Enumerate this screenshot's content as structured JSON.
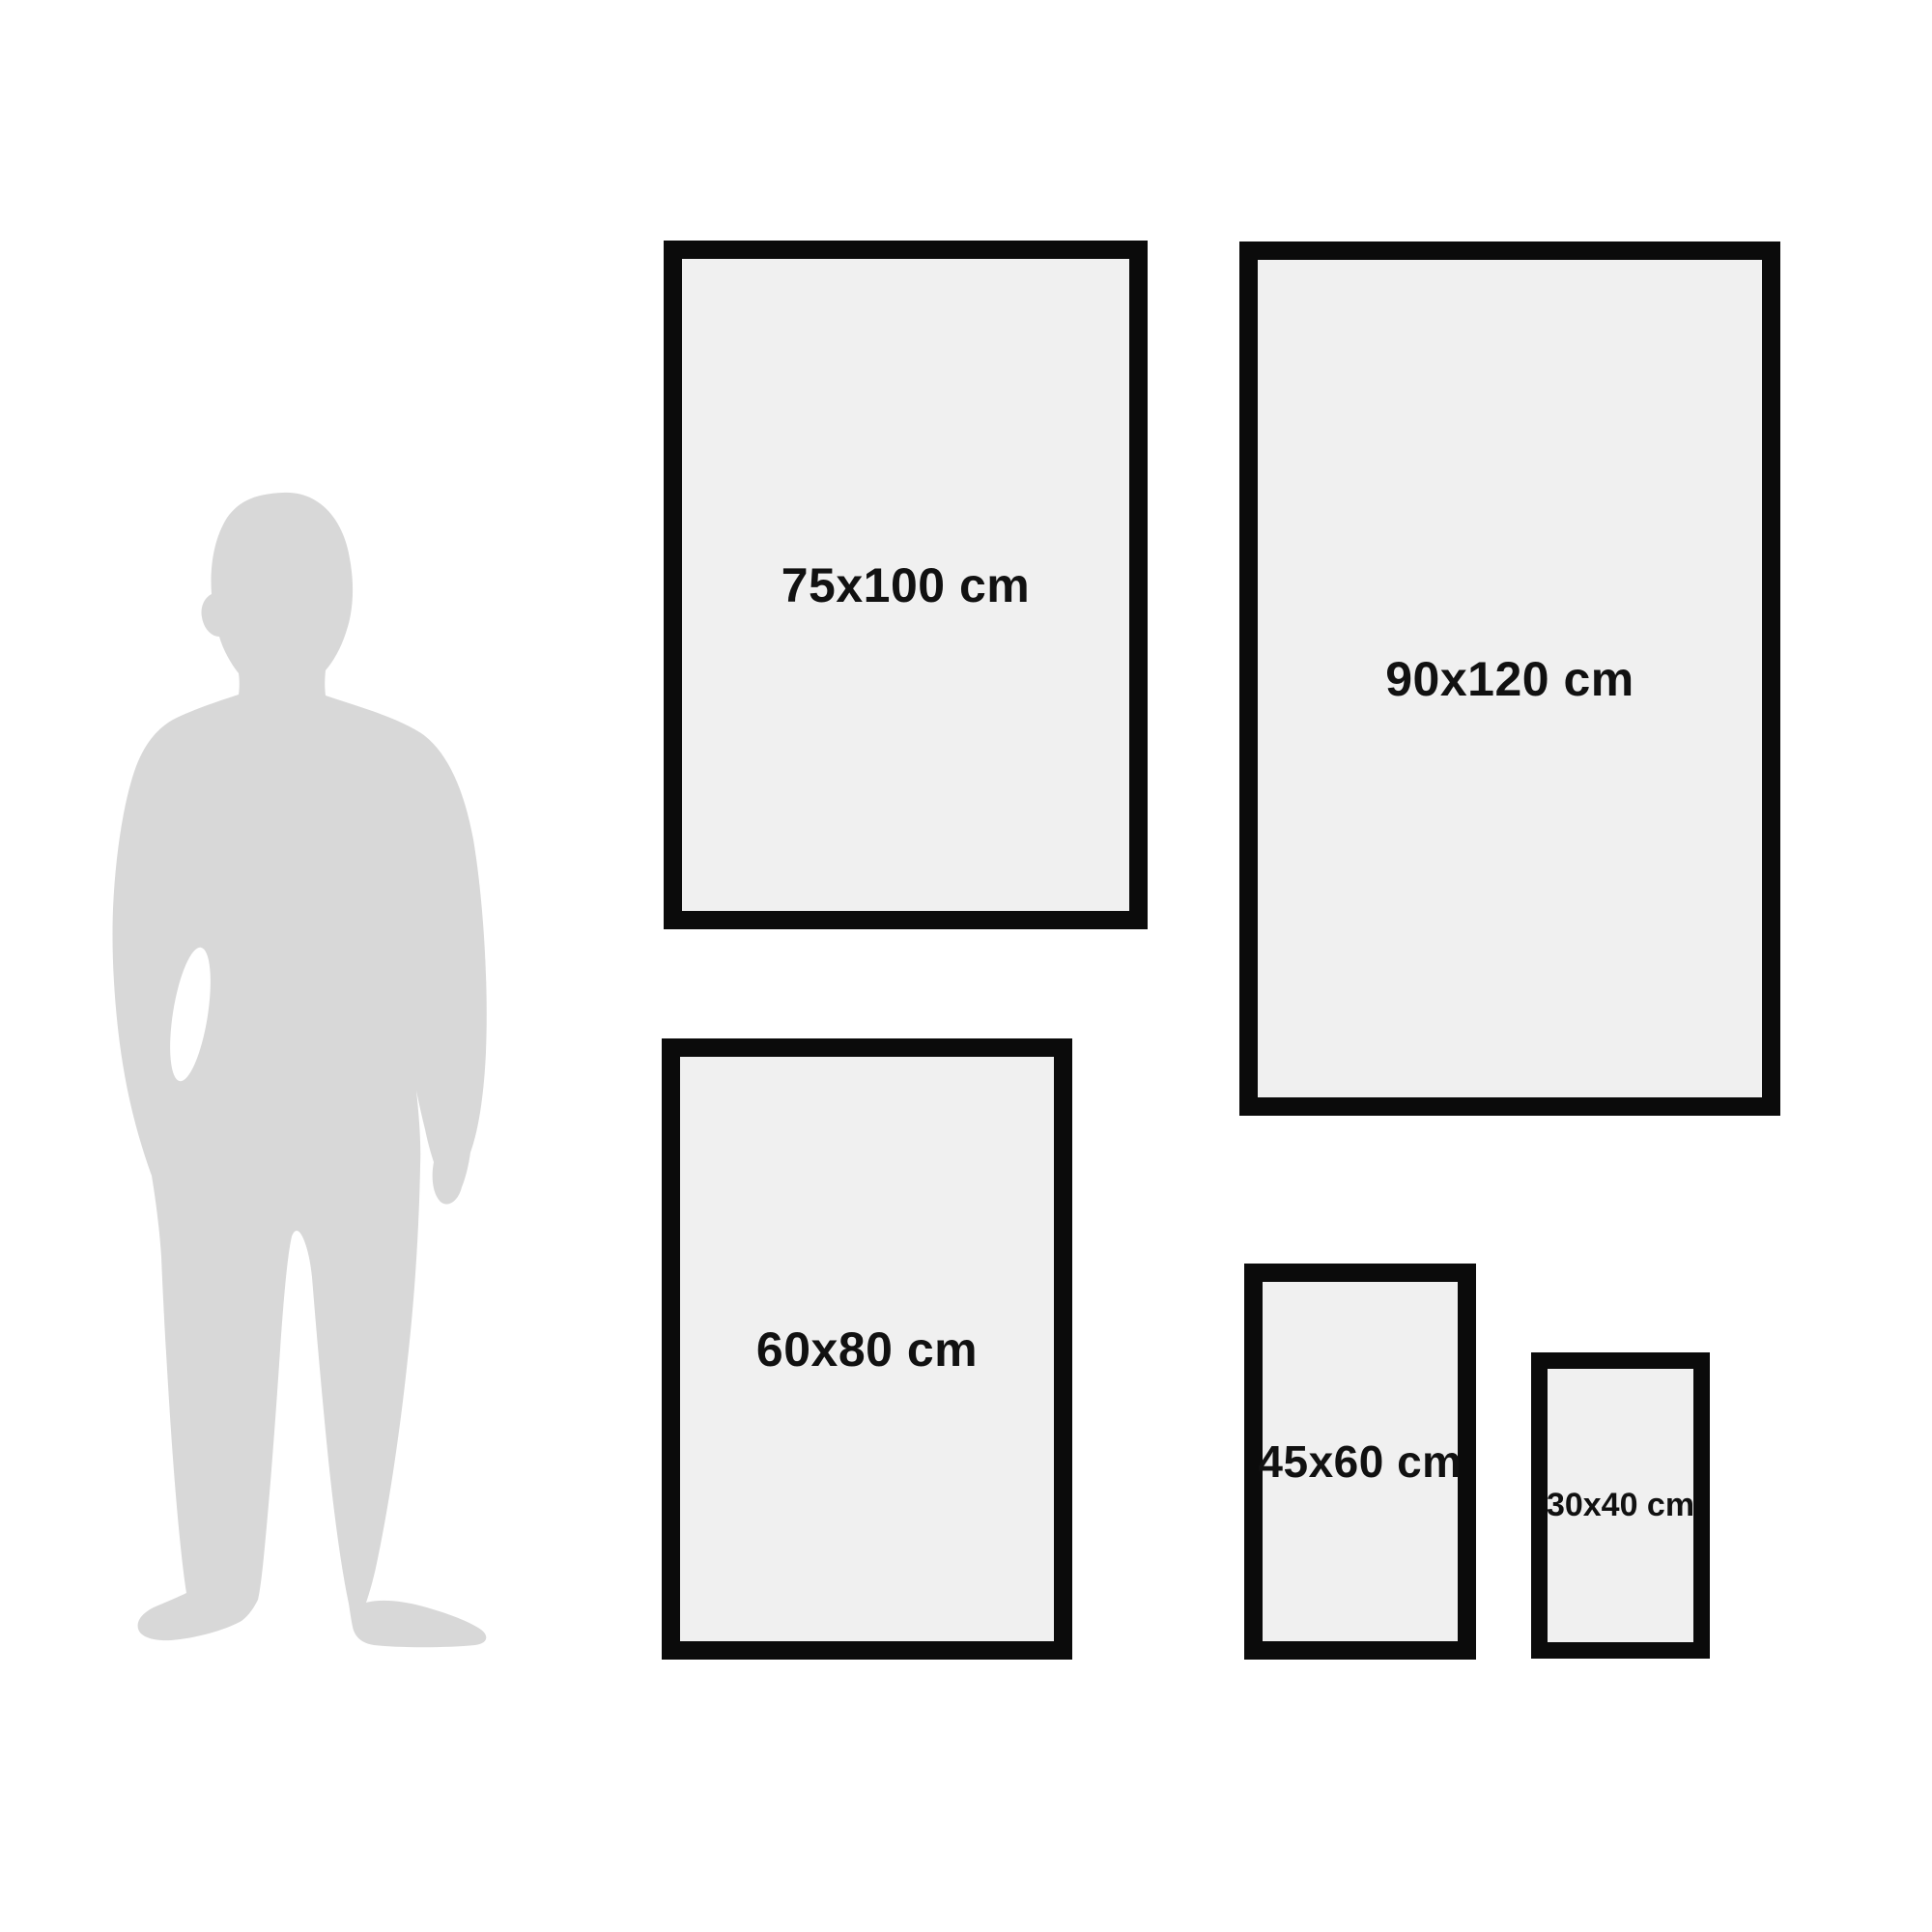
{
  "diagram": {
    "frames": [
      {
        "id": "75x100",
        "label": "75x100 cm"
      },
      {
        "id": "90x120",
        "label": "90x120 cm"
      },
      {
        "id": "60x80",
        "label": "60x80 cm"
      },
      {
        "id": "45x60",
        "label": "45x60 cm"
      },
      {
        "id": "30x40",
        "label": "30x40 cm"
      }
    ],
    "silhouette": {
      "icon": "man-silhouette-icon",
      "color": "#d8d8d8"
    },
    "colors": {
      "background": "#ffffff",
      "frame_border": "#0b0b0b",
      "frame_fill": "#f0f0f0",
      "label_text": "#111111"
    }
  }
}
